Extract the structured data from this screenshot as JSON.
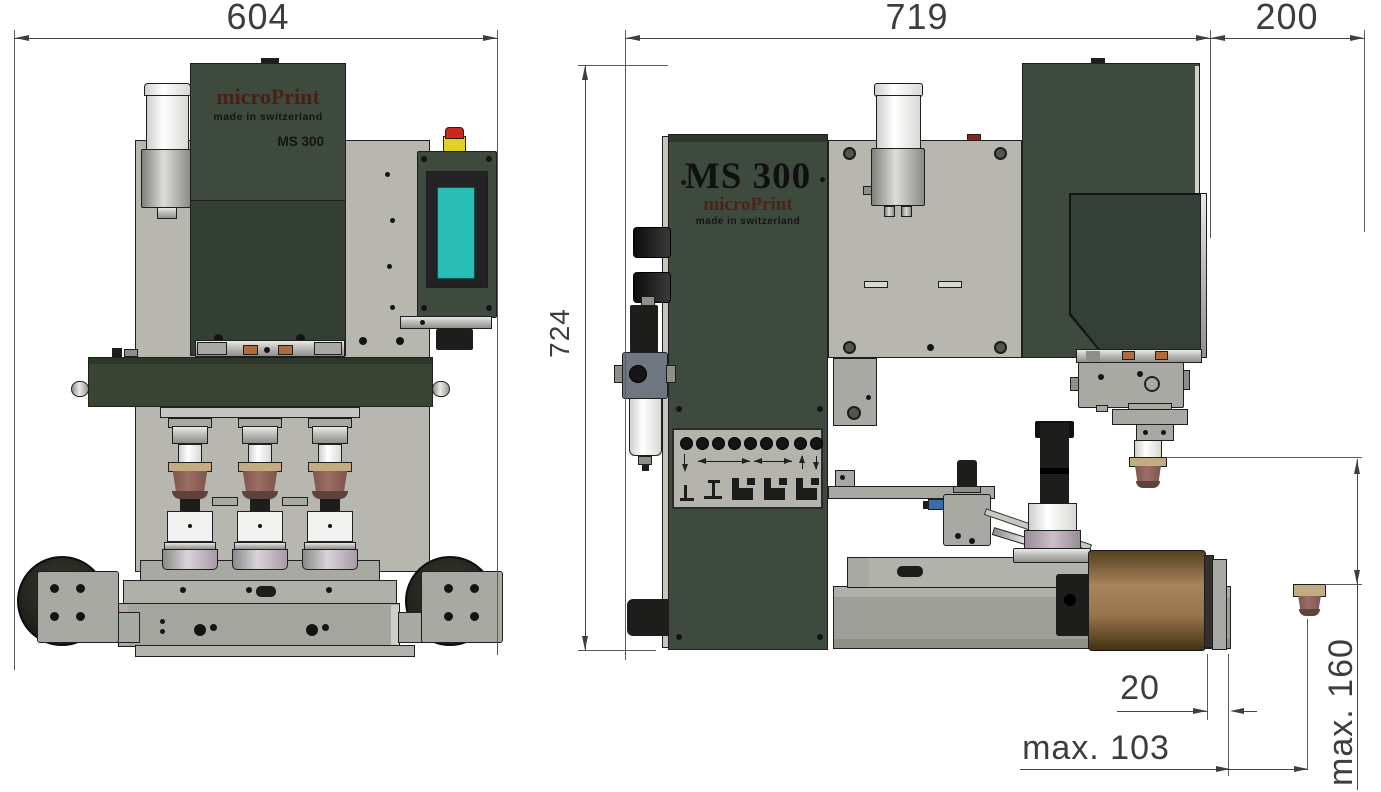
{
  "drawing": {
    "front_view": {
      "width_dim": "604",
      "height_dim": "724",
      "nameplate": {
        "brand": "microPrint",
        "origin": "made in switzerland",
        "model": "MS 300"
      }
    },
    "side_view": {
      "width_dim": "719",
      "offset_dim": "200",
      "nameplate": {
        "model": "MS 300",
        "brand": "microPrint",
        "origin": "made in switzerland"
      },
      "pad_clearance_dim": "20",
      "max_stroke_dim": "max. 103",
      "max_pad_height_dim": "max. 160"
    }
  },
  "colors": {
    "machine_green": "#3f4a3e",
    "machine_green_dark": "#333f35",
    "panel_gray": "#b7b7b0",
    "screen_teal": "#2abdb6",
    "estop_red": "#c8281e",
    "estop_yellow": "#e3cf2a",
    "pad_brown": "#8d615a",
    "pad_ring_tan": "#c3ac83",
    "roller_brown": "#9a7a52",
    "brand_maroon": "#53261f",
    "dimension_line": "#4a4a4a"
  }
}
